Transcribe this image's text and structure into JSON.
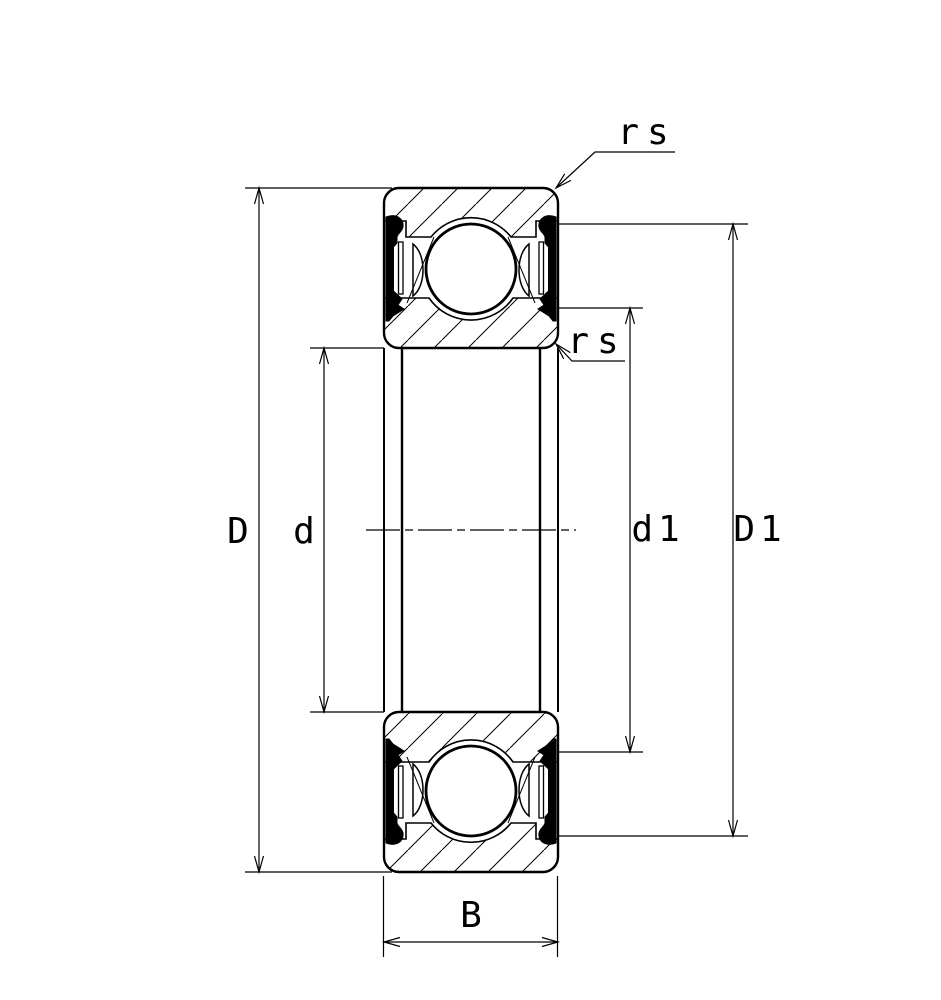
{
  "figure": {
    "kind": "bearing-cross-section-diagram",
    "labels": {
      "D": "D",
      "d": "d",
      "d1": "d1",
      "D1": "D1",
      "B": "B",
      "rs_outer": "rs",
      "rs_inner": "rs"
    },
    "colors": {
      "line": "#000000",
      "background": "#ffffff"
    }
  }
}
